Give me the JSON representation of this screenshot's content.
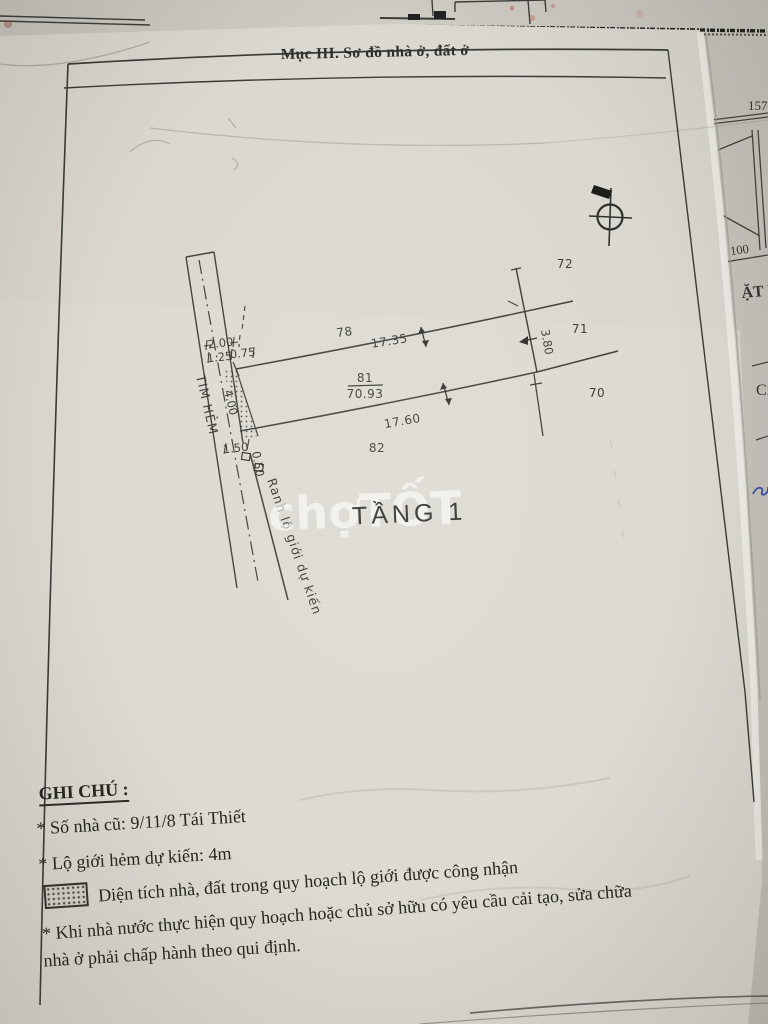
{
  "page": {
    "section_title": "Mục III. Sơ đồ nhà ở, đất ở",
    "watermark": "chợTỐT"
  },
  "diagram": {
    "floor_label": "TẦNG 1",
    "alley_centerline_label": "TIM HẺM",
    "planned_boundary_label": "Ranh lộ giới dự kiến",
    "main_parcel": {
      "number": "81",
      "area": "70.93"
    },
    "parcel_labels": {
      "p78": "78",
      "p82": "82",
      "p72": "72",
      "p71": "71",
      "p70": "70"
    },
    "dims": {
      "top": "17.35",
      "bottom": "17.60",
      "right": "3.80",
      "d200": "2.00",
      "d125": "1.25",
      "d075": "0.75",
      "d400": "4.00",
      "d150": "1.50",
      "d050": "0.50"
    }
  },
  "notes": {
    "heading": "GHI CHÚ :",
    "item_old_address": "* Số nhà cũ: 9/11/8 Tái Thiết",
    "item_alley_width": "* Lộ giới hẻm dự kiến: 4m",
    "item_hatch": "Diện  tích nhà, đất trong quy hoạch lộ giới được công nhận",
    "item_regulation_1": "* Khi nhà nước thực hiện quy hoạch hoặc chủ sở hữu có yêu cầu cải tạo, sửa chữa",
    "item_regulation_2": "nhà ở phải chấp hành theo qui định."
  },
  "adjacent_sheet": {
    "num_157": "157",
    "num_100": "100",
    "frag_mat_bang": "ẶT BẰ",
    "frag_ci": "Cị"
  },
  "colors": {
    "paper": "#dbd8d1",
    "ink": "#3a3a36",
    "watermark": "#ffffff",
    "blue_pen": "#4050a8"
  }
}
